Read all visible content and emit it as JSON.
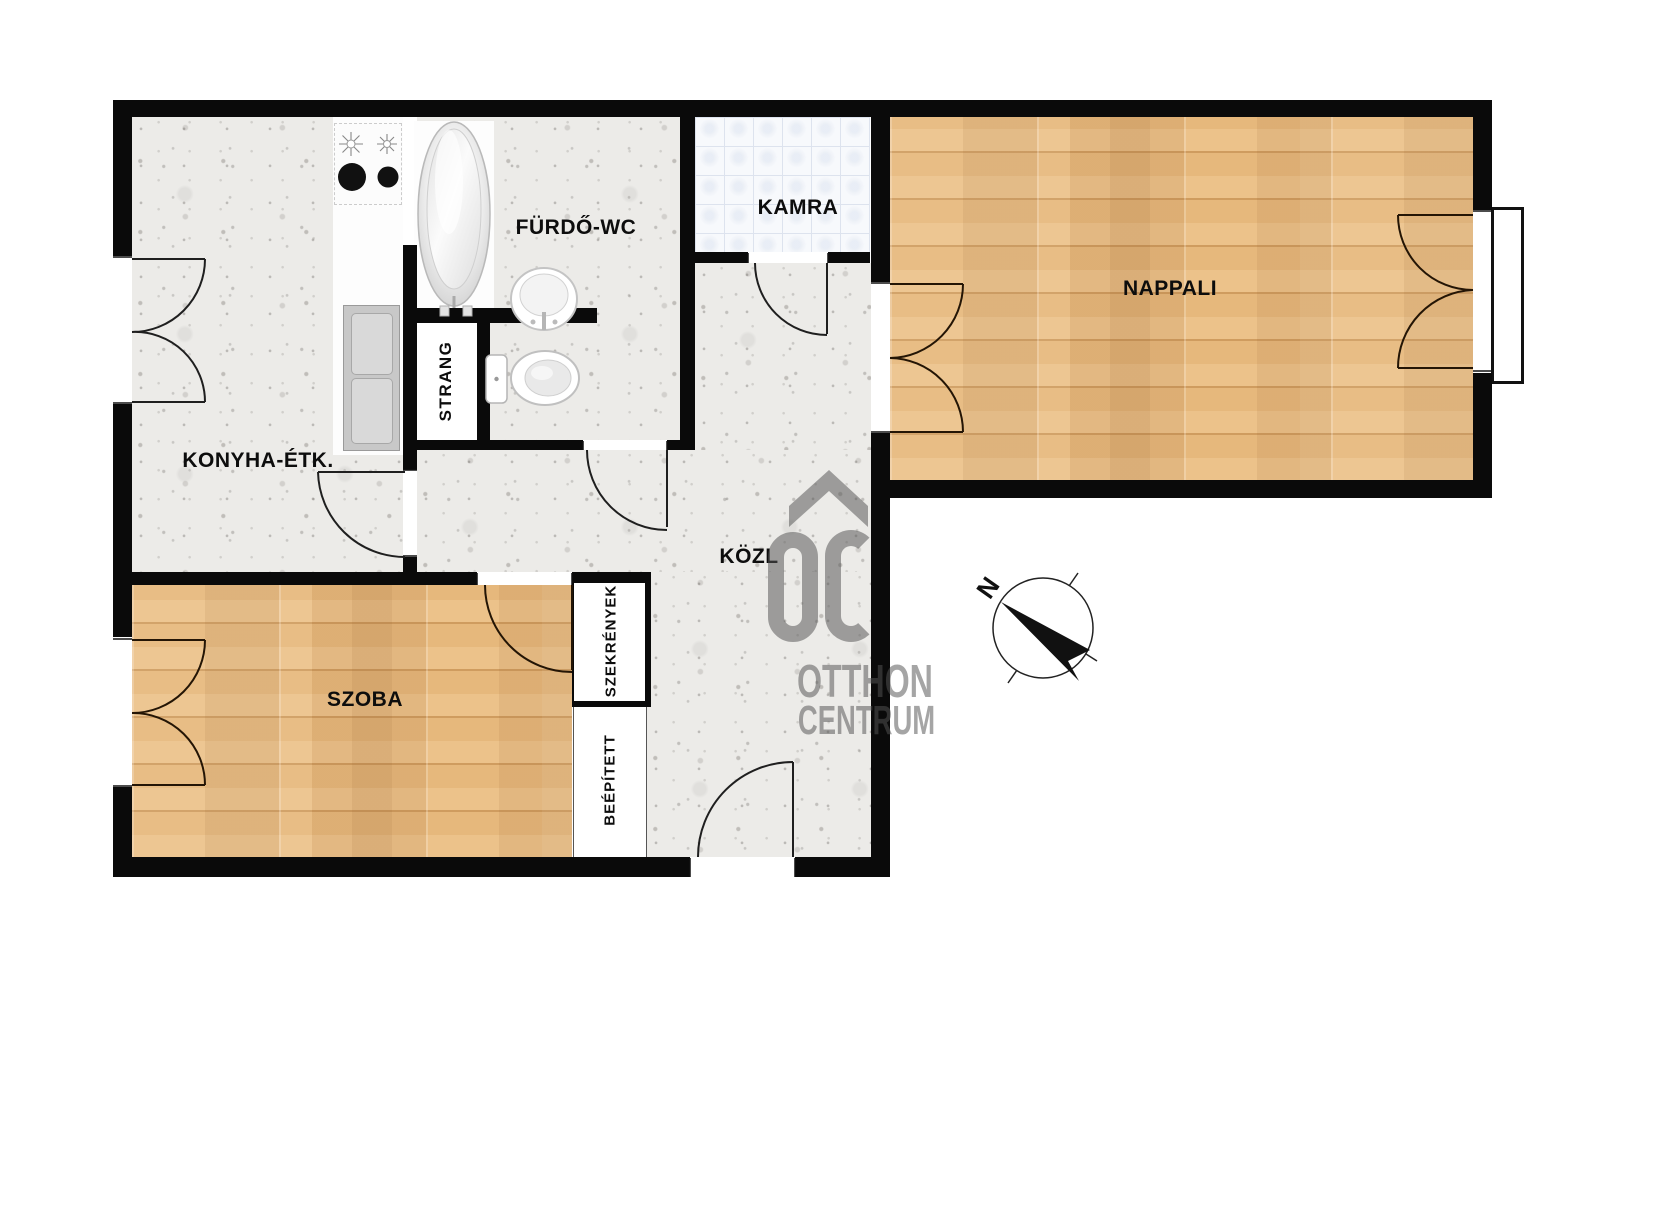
{
  "plan_type": "apartment floor plan",
  "rooms": {
    "konyha": {
      "label": "KONYHA-ÉTK."
    },
    "furdo": {
      "label": "FÜRDŐ-WC"
    },
    "kamra": {
      "label": "KAMRA"
    },
    "nappali": {
      "label": "NAPPALI"
    },
    "kozl": {
      "label": "KÖZL"
    },
    "szoba": {
      "label": "SZOBA"
    }
  },
  "annotations": {
    "strang": {
      "label": "STRANG"
    },
    "szekrenyek": {
      "label": "SZEKRÉNYEK"
    },
    "beepitett": {
      "label": "BEÉPÍTETT"
    }
  },
  "compass": {
    "north_label": "N"
  },
  "watermark": {
    "initials": "OC",
    "line1": "OTTHON",
    "line2": "CENTRUM"
  },
  "icons": [
    "bathtub-icon",
    "washbasin-icon",
    "toilet-icon",
    "stove-burners-icon",
    "kitchen-sink-icon",
    "compass-rose-icon",
    "house-roof-watermark-icon"
  ],
  "colors": {
    "wall": "#0a0a0a",
    "wood_floor": "#e3b277",
    "concrete_floor": "#ecebe8",
    "tile_floor": "#f7f9fc",
    "tile_line": "#dde3ee",
    "label_text": "#0d0d0d",
    "watermark_gray": "#9a9a9a"
  }
}
